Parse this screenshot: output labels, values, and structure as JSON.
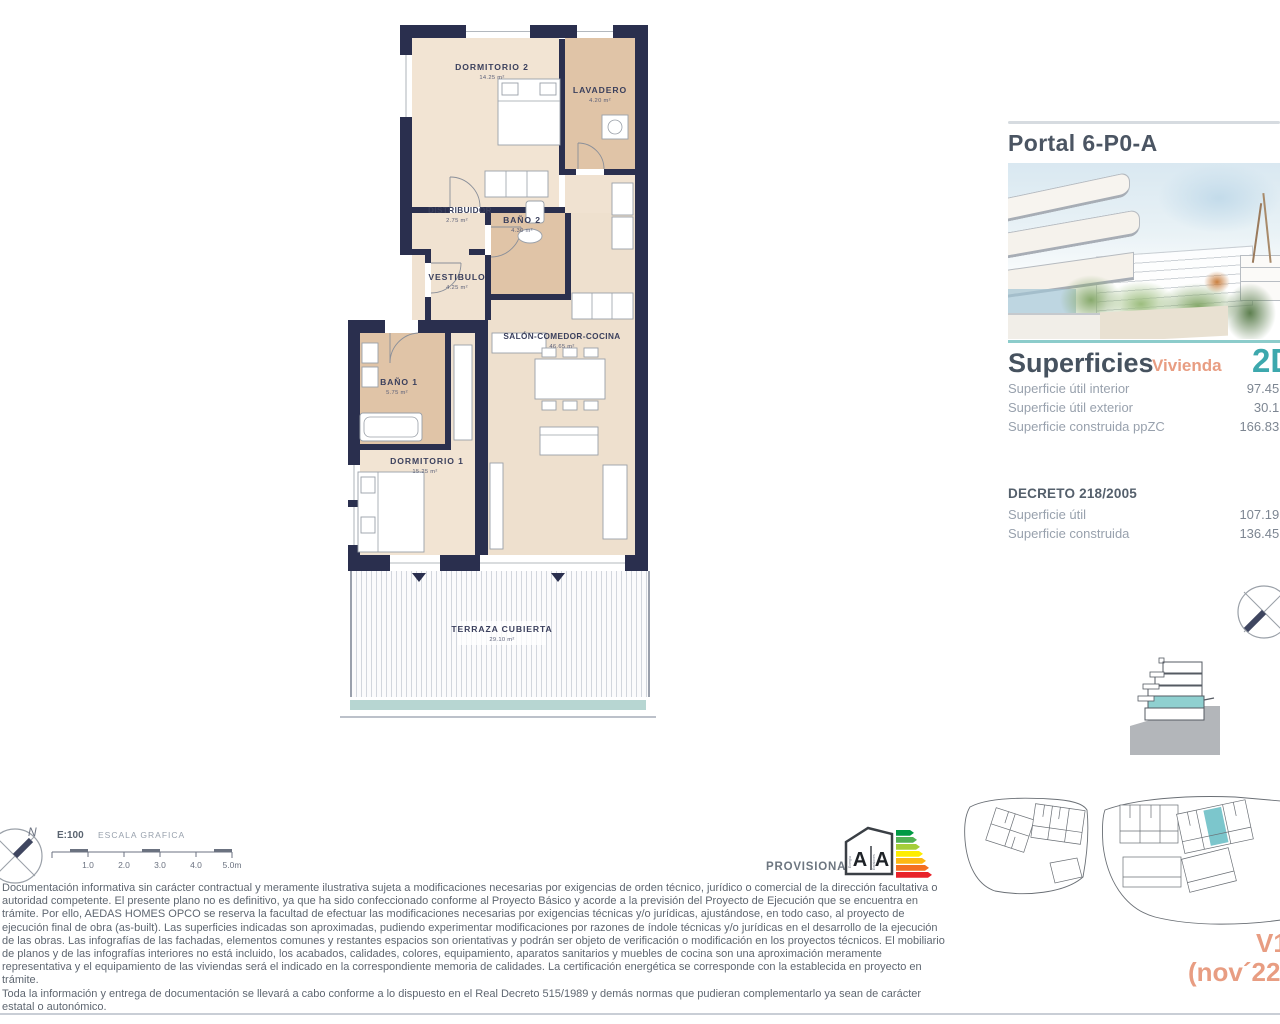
{
  "floor_plan": {
    "rooms": [
      {
        "name": "DORMITORIO 2",
        "area": "14.25 m²"
      },
      {
        "name": "LAVADERO",
        "area": "4.20 m²"
      },
      {
        "name": "DISTRIBUIDOR",
        "area": "2.75 m²"
      },
      {
        "name": "BAÑO 2",
        "area": "4.30 m²"
      },
      {
        "name": "VESTIBULO",
        "area": "4.25 m²"
      },
      {
        "name": "SALÓN-COMEDOR-COCINA",
        "area": "46.65 m²"
      },
      {
        "name": "BAÑO 1",
        "area": "5.75 m²"
      },
      {
        "name": "DORMITORIO 1",
        "area": "15.25 m²"
      },
      {
        "name": "TERRAZA CUBIERTA",
        "area": "29.10 m²"
      }
    ]
  },
  "scale_bar": {
    "north": "N",
    "ratio": "E:100",
    "label": "ESCALA GRAFICA",
    "ticks": [
      "1.0",
      "2.0",
      "3.0",
      "4.0",
      "5.0m"
    ]
  },
  "stamps": {
    "provisional": "PROVISIONAL",
    "energy_letter_left": "A",
    "energy_letter_right": "A",
    "energy_word_left": "Energía",
    "energy_word_right": "Emisiones"
  },
  "side_panel": {
    "portal_title": "Portal 6-P0-A",
    "superficies_title": "Superficies",
    "vivienda_label": "Vivienda",
    "vivienda_type": "2D",
    "rows": [
      {
        "label": "Superficie útil interior",
        "value": "97.45 m²"
      },
      {
        "label": "Superficie útil exterior",
        "value": "30.1 m²"
      },
      {
        "label": "Superficie construida ppZC",
        "value": "166.83 m²"
      }
    ],
    "decreto_title": "DECRETO 218/2005",
    "decreto_rows": [
      {
        "label": "Superficie útil",
        "value": "107.19 m²"
      },
      {
        "label": "Superficie construida",
        "value": "136.45 m²"
      }
    ]
  },
  "footer": {
    "disclaimer_p1": "Documentación informativa sin carácter contractual y meramente ilustrativa sujeta a modificaciones necesarias por exigencias de orden técnico, jurídico o comercial de la dirección facultativa o autoridad competente. El presente plano no es definitivo, ya que ha sido  confeccionado conforme al Proyecto Básico y acorde a la previsión del Proyecto de Ejecución que se encuentra en trámite. Por ello, AEDAS HOMES OPCO se reserva la facultad de efectuar las modificaciones necesarias por exigencias técnicas y/o jurídicas, ajustándose, en todo caso, al proyecto de ejecución final de obra (as-built). Las superficies indicadas son aproximadas, pudiendo experimentar modificaciones por razones de índole técnicas y/o jurídicas en el desarrollo de la ejecución de las obras. Las infografías de las fachadas, elementos comunes y restantes espacios son orientativas y podrán ser objeto de verificación o modificación en los proyectos técnicos. El mobiliario de planos y de las infografías interiores no está incluido, los acabados, calidades, colores, equipamiento, aparatos sanitarios y muebles de cocina son una aproximación meramente representativa y el equipamiento de las viviendas será el indicado en la correspondiente memoria de calidades. La certificación energética se corresponde con la establecida en proyecto en trámite.",
    "disclaimer_p2": "Toda la información y entrega de documentación se llevará a cabo conforme a lo dispuesto en el Real Decreto 515/1989 y demás normas que pudieran complementarlo ya sean de carácter estatal o autonómico.",
    "version": "V1",
    "date": "(nov´22)"
  },
  "colors": {
    "wall_navy": "#2a2f4e",
    "room_cream": "#f2e4d3",
    "room_tan": "#e0c4a7",
    "accent_teal": "#3da8ad",
    "divider_teal": "#8ccccb",
    "accent_salmon": "#e89d82",
    "heading_slate": "#4b5563",
    "site_highlight_teal": "#7cc6cc"
  }
}
